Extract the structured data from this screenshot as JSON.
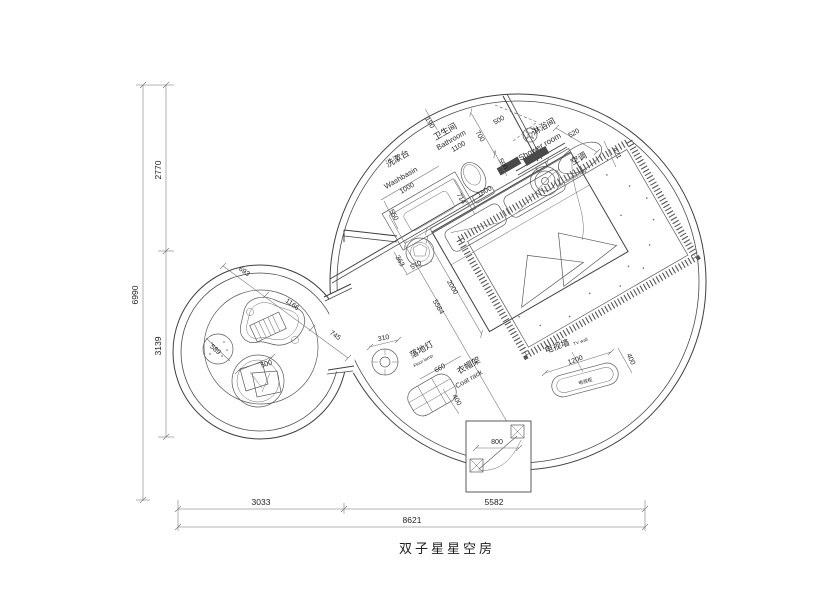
{
  "title": "双子星星空房",
  "dim_left": {
    "total": "6990",
    "top": "2770",
    "bottom": "3139"
  },
  "dim_bottom": {
    "left": "3033",
    "right": "5582",
    "total": "8621"
  },
  "washbasin": {
    "label_zh": "洗漱台",
    "label_en": "Washbasin",
    "d_length": "1000",
    "d_depth": "550"
  },
  "bathroom": {
    "label_zh": "卫生间",
    "label_en": "Bathroom",
    "d_width": "1100",
    "d_gap": "190",
    "d_depth": "700",
    "d_door": "714",
    "d_screen": "590"
  },
  "shower": {
    "label_zh": "淋浴间",
    "label_en": "Shower room",
    "d_door": "500"
  },
  "ac": {
    "label_zh": "空调",
    "label_en": "air conditioning",
    "d_width": "520",
    "d_depth": "421"
  },
  "bed": {
    "d_width": "1800",
    "d_length": "2000",
    "d_diag": "5584",
    "d_stool": "363",
    "d_side": "570"
  },
  "floor_lamp": {
    "label_zh": "落地灯",
    "label_en": "Floor lamp",
    "d": "310"
  },
  "coat_rack": {
    "label_zh": "衣帽架",
    "label_en": "Coat rack",
    "d_length": "660",
    "d_depth": "400"
  },
  "tv": {
    "label_zh": "电视墙",
    "label_en": "TV wall",
    "cabinet": "电视柜",
    "d_length": "1200",
    "d_depth": "400"
  },
  "entrance": {
    "d_door": "800"
  },
  "lounge": {
    "d_1": "693",
    "d_2": "1166",
    "d_3": "745",
    "d_pouf": "589",
    "d_chair": "500"
  }
}
